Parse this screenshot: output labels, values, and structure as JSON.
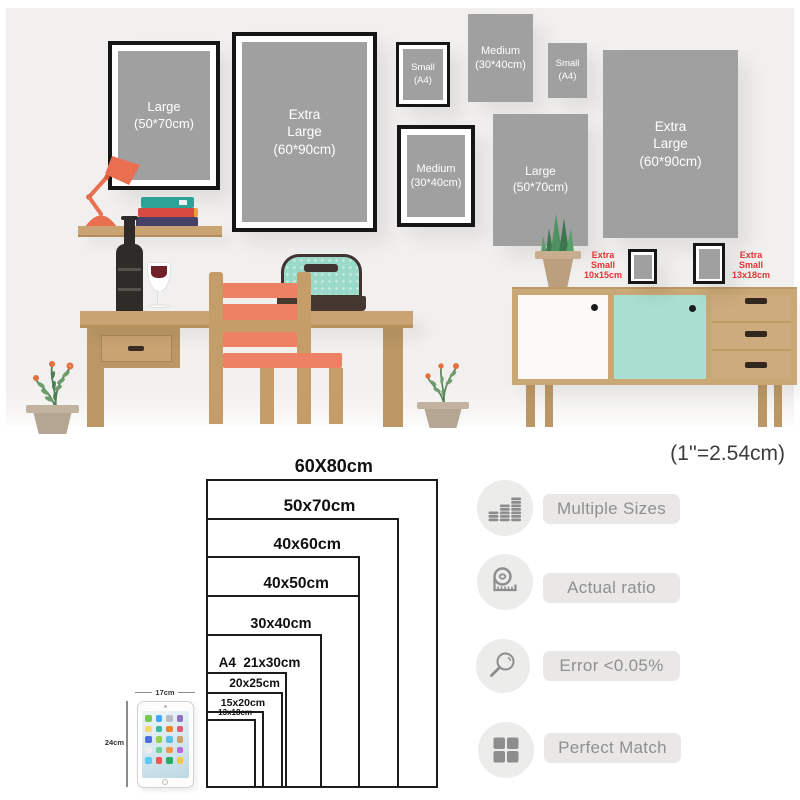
{
  "scene": {
    "wall_frames": [
      {
        "label": "Large\n(50*70cm)",
        "frame": "black"
      },
      {
        "label": "Extra\nLarge\n(60*90cm)",
        "frame": "black"
      },
      {
        "label": "Small\n(A4)",
        "frame": "black"
      },
      {
        "label": "Medium\n(30*40cm)",
        "frame": "none"
      },
      {
        "label": "Small\n(A4)",
        "frame": "none"
      },
      {
        "label": "Medium\n(30*40cm)",
        "frame": "black"
      },
      {
        "label": "Large\n(50*70cm)",
        "frame": "none"
      },
      {
        "label": "Extra\nLarge\n(60*90cm)",
        "frame": "none"
      }
    ],
    "tabletop_frames": [
      {
        "label": "Extra\nSmall\n10x15cm"
      },
      {
        "label": "Extra\nSmall\n13x18cm"
      }
    ]
  },
  "size_chart": {
    "unit_note": "(1''=2.54cm)",
    "sizes": [
      {
        "label": "60X80cm",
        "w_cm": 60,
        "h_cm": 80
      },
      {
        "label": "50x70cm",
        "w_cm": 50,
        "h_cm": 70
      },
      {
        "label": "40x60cm",
        "w_cm": 40,
        "h_cm": 60
      },
      {
        "label": "40x50cm",
        "w_cm": 40,
        "h_cm": 50
      },
      {
        "label": "30x40cm",
        "w_cm": 30,
        "h_cm": 40
      },
      {
        "label": "A4  21x30cm",
        "w_cm": 21,
        "h_cm": 30
      },
      {
        "label": "20x25cm",
        "w_cm": 20,
        "h_cm": 25
      },
      {
        "label": "15x20cm",
        "w_cm": 15,
        "h_cm": 20
      },
      {
        "label": "13x18cm",
        "w_cm": 13,
        "h_cm": 18
      }
    ],
    "tablet": {
      "width_label": "17cm",
      "height_label": "24cm"
    }
  },
  "features": [
    {
      "icon": "coins-icon",
      "label": "Multiple Sizes"
    },
    {
      "icon": "tape-measure-icon",
      "label": "Actual ratio"
    },
    {
      "icon": "magnifier-icon",
      "label": "Error <0.05%"
    },
    {
      "icon": "grid-icon",
      "label": "Perfect Match"
    }
  ],
  "colors": {
    "wall_bg": "#f1f0ee",
    "frame_fill": "#a0a0a0",
    "frame_border": "#161616",
    "accent_red": "#e23434",
    "wood": "#c9a371",
    "coral": "#ee8164",
    "mint": "#a9dfd0",
    "bag_teal": "#9bd9c9",
    "icon_gray": "#8d8d8d"
  }
}
